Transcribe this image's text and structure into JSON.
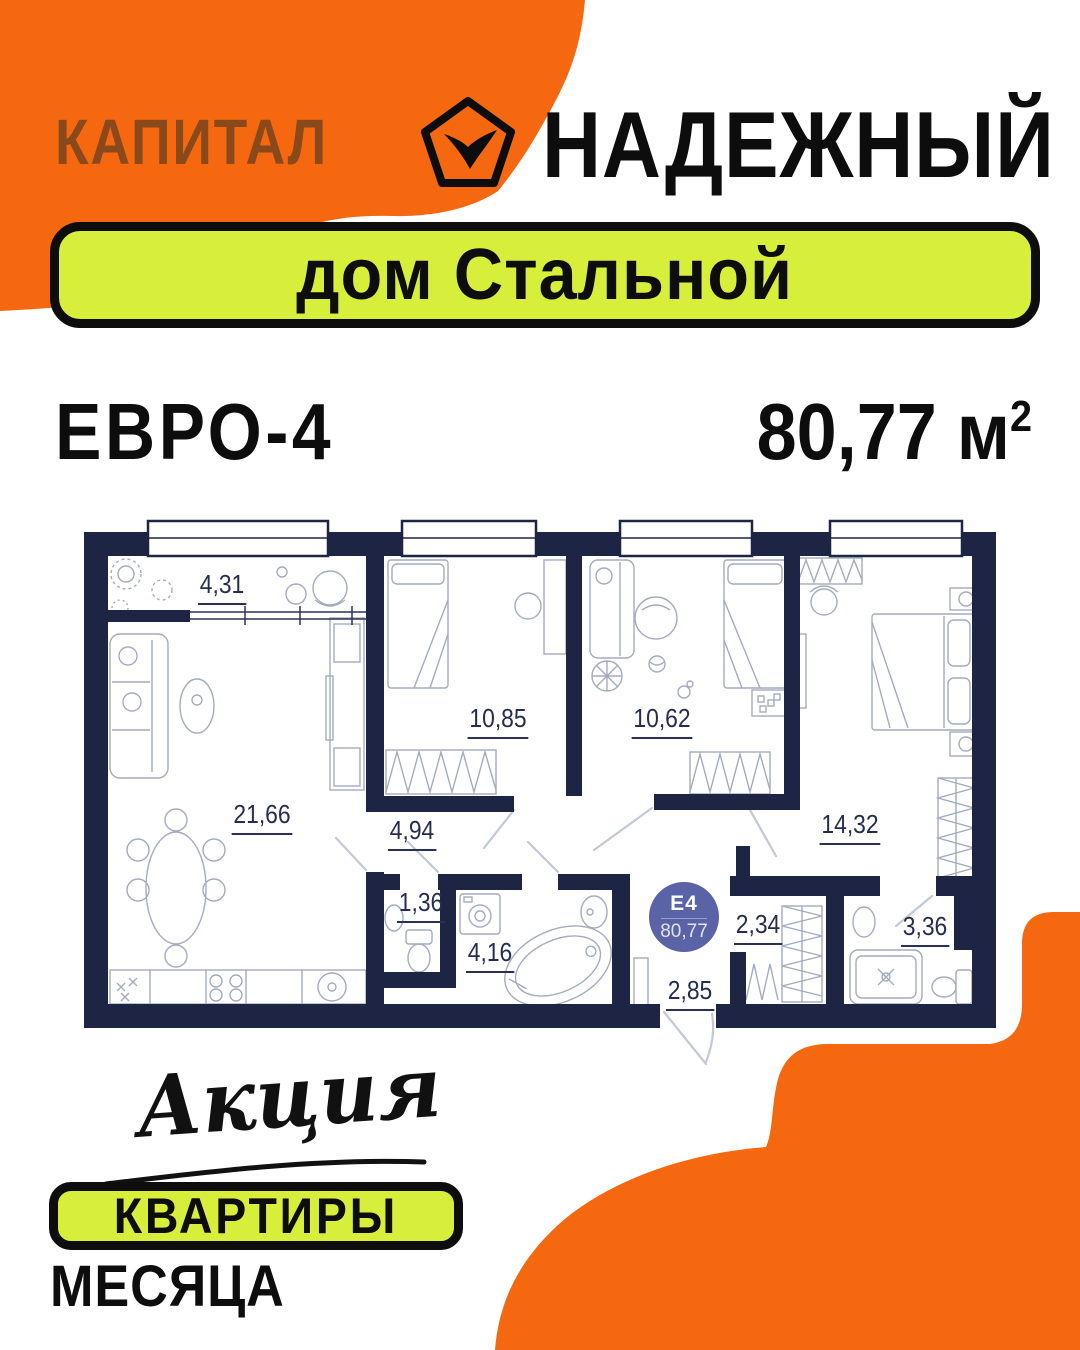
{
  "header": {
    "brand": "КАПИТАЛ",
    "partner": "НАДЕЖНЫЙ",
    "logo_icon": "pentagon-check-icon",
    "banner": "дом Стальной"
  },
  "listing": {
    "layout_type": "ЕВРО-4",
    "total_area": "80,77 м",
    "area_superscript": "2"
  },
  "floor_plan": {
    "unit_badge": {
      "code": "Е4",
      "area": "80,77"
    },
    "rooms": [
      {
        "name": "loggia",
        "area": "4,31"
      },
      {
        "name": "living-kitchen",
        "area": "21,66"
      },
      {
        "name": "bedroom-1",
        "area": "10,85"
      },
      {
        "name": "children-room",
        "area": "10,62"
      },
      {
        "name": "bedroom-2",
        "area": "14,32"
      },
      {
        "name": "hallway",
        "area": "4,94"
      },
      {
        "name": "wc",
        "area": "1,36"
      },
      {
        "name": "bathroom",
        "area": "4,16"
      },
      {
        "name": "corridor",
        "area": "2,85"
      },
      {
        "name": "wardrobe",
        "area": "2,34"
      },
      {
        "name": "shower-room",
        "area": "3,36"
      }
    ]
  },
  "promo": {
    "headline_script": "Акция",
    "badge": "КВАРТИРЫ",
    "subline": "МЕСЯЦА"
  },
  "colors": {
    "orange": "#F5680F",
    "lime": "#D7EF3B",
    "navy": "#1E2443",
    "brand_brown": "#8A491B",
    "unit_badge_fill": "#5A63A6"
  }
}
